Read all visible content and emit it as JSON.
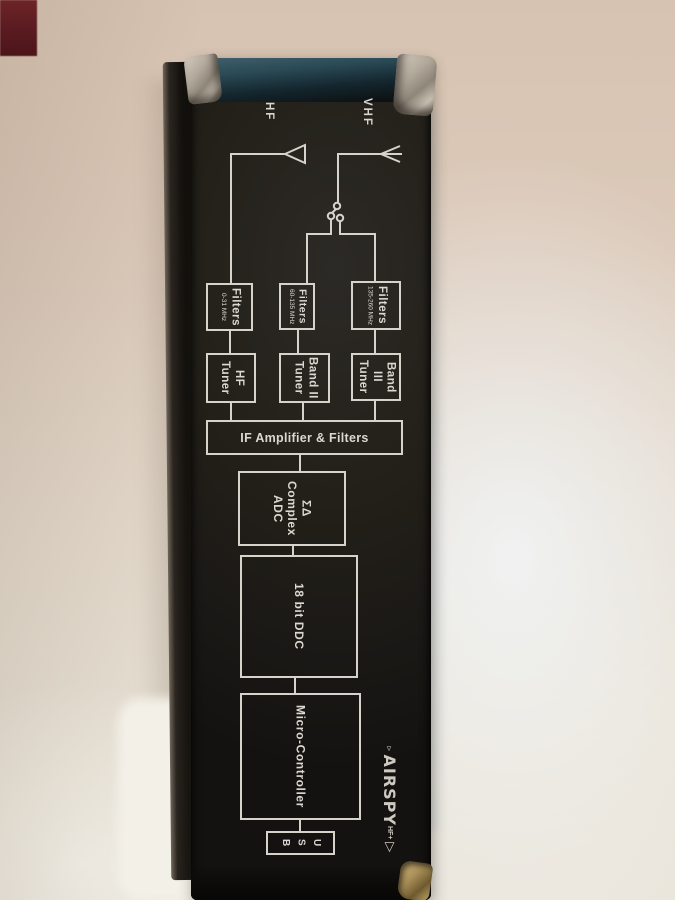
{
  "colors": {
    "wall_beige": "#dccaba",
    "surface_white": "#f3f0e8",
    "box_black": "#201e1a",
    "box_top_teal": "#2a4a56",
    "diagram_line": "#d6d3cb",
    "foil_silver": "#b3aa9c",
    "foil_gold": "#a98f58",
    "pen_red": "#9c4055",
    "corner_patch_red": "#571a1f"
  },
  "diagram": {
    "antenna_labels": {
      "hf": "HF",
      "vhf": "VHF"
    },
    "filters": [
      {
        "title": "Filters",
        "range": "0-31 MHz"
      },
      {
        "title": "Filters",
        "range": "60-135 MHz"
      },
      {
        "title": "Filters",
        "range": "135-260 MHz"
      }
    ],
    "tuners": [
      {
        "line1": "HF",
        "line2": "Tuner"
      },
      {
        "line1": "Band II",
        "line2": "Tuner"
      },
      {
        "line1": "Band III",
        "line2": "Tuner"
      }
    ],
    "if_bar": "IF Amplifier & Filters",
    "adc": {
      "line1": "ΣΔ",
      "line2": "Complex",
      "line3": "ADC"
    },
    "ddc": "18 bit DDC",
    "mcu": "Micro-Controller",
    "usb": [
      "U",
      "S",
      "B"
    ],
    "icons": [
      "antenna-icon",
      "spdt-switch-icon"
    ]
  },
  "logo": {
    "brand": "AIRSPY",
    "variant": "HF+",
    "glyph_small": "▿",
    "glyph_big": "▽"
  },
  "annotations": {
    "pen_mark": "10"
  }
}
